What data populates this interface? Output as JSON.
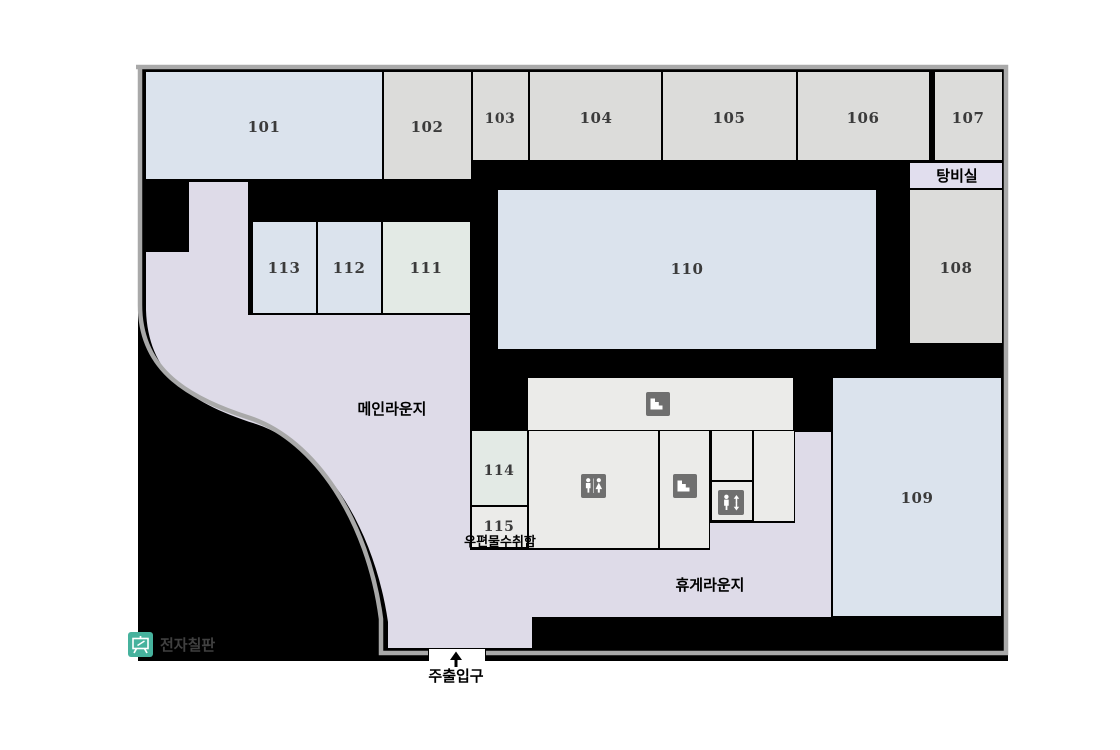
{
  "colors": {
    "page_bg": "#ffffff",
    "wall": "#000000",
    "outer_line": "#a9a9a9",
    "room_blue": "#dbe3ed",
    "room_gray": "#dcdcda",
    "room_green": "#e3eae5",
    "room_light": "#ebebe9",
    "lounge": "#dedbe8",
    "pantry": "#e1deee",
    "icon_bg": "#6f6f6f",
    "icon_fg": "#ffffff",
    "board_icon_bg": "#46b29d",
    "number_text": "#3b3b3b",
    "korean_text": "#000000",
    "board_label_text": "#404040"
  },
  "rooms": {
    "r101": "101",
    "r102": "102",
    "r103": "103",
    "r104": "104",
    "r105": "105",
    "r106": "106",
    "r107": "107",
    "r108": "108",
    "r109": "109",
    "r110": "110",
    "r111": "111",
    "r112": "112",
    "r113": "113",
    "r114": "114",
    "r115": "115"
  },
  "areas": {
    "pantry": "탕비실",
    "main_lounge": "메인라운지",
    "rest_lounge": "휴게라운지"
  },
  "labels": {
    "mailbox": "우편물수취함",
    "main_entrance": "주출입구",
    "electronic_board": "전자칠판"
  },
  "icons": {
    "stairs": "stairs-icon",
    "restroom": "restroom-icon",
    "elevator": "elevator-icon",
    "electronic_board": "electronic-board-icon",
    "entrance_arrow": "up-arrow-icon"
  }
}
